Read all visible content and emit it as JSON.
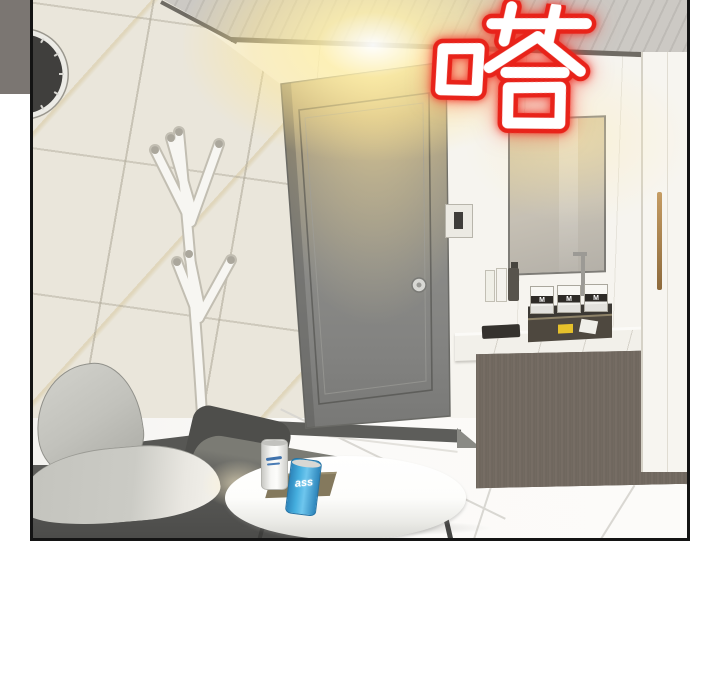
{
  "scene": {
    "description": "Webtoon interior panel: room with gray door, marble-tiled wall, wall clock, white coat rack, ceiling light, vanity with mirror and wood cabinet, dark sofa with light cushions, round white table with two beer cans and a snack box",
    "sfx": {
      "text": "嗒",
      "fill_color": "#ffffff",
      "outline_color": "#e8231a"
    },
    "cups": [
      "M",
      "M",
      "M"
    ],
    "cans": {
      "blue_can_text": "ass",
      "blue_can_color": "#47b0e4",
      "white_can_color": "#f2f2ef"
    },
    "objects": [
      "wall-clock",
      "coat-rack",
      "door",
      "door-knob",
      "light-switch",
      "ceiling-light-glow",
      "mirror",
      "soap-bottles",
      "faucet",
      "toothbrush-cups",
      "vanity-tray",
      "vanity-counter",
      "vanity-cabinet",
      "tall-cabinet",
      "brass-handle",
      "sofa",
      "cushions",
      "coffee-table",
      "white-beer-can",
      "blue-beer-can",
      "snack-box",
      "tile-floor"
    ],
    "palette": {
      "panel_border": "#141414",
      "outside_gutter": "#7b7672",
      "wall_tile": "#eae6db",
      "back_wall": "#f3f1eb",
      "ceiling": "#c7c4bf",
      "ceiling_trim": "#6f6b64",
      "door": "#8a8a87",
      "door_glow_top": "#b3a279",
      "light_glow": "#ffeeb0",
      "sofa": "#565654",
      "cushion": "#c9c9c3",
      "table_top": "#fbfbf9",
      "vanity_wood": "#6f675f",
      "counter_marble": "#f3f1eb",
      "tall_cabinet": "#f7f5f0",
      "brass_handle": "#b08a55",
      "floor": "#fbfaf8",
      "clock_face": "#403f3d",
      "mirror_reflection": "#dccb9e",
      "sfx_red": "#e8231a"
    }
  }
}
